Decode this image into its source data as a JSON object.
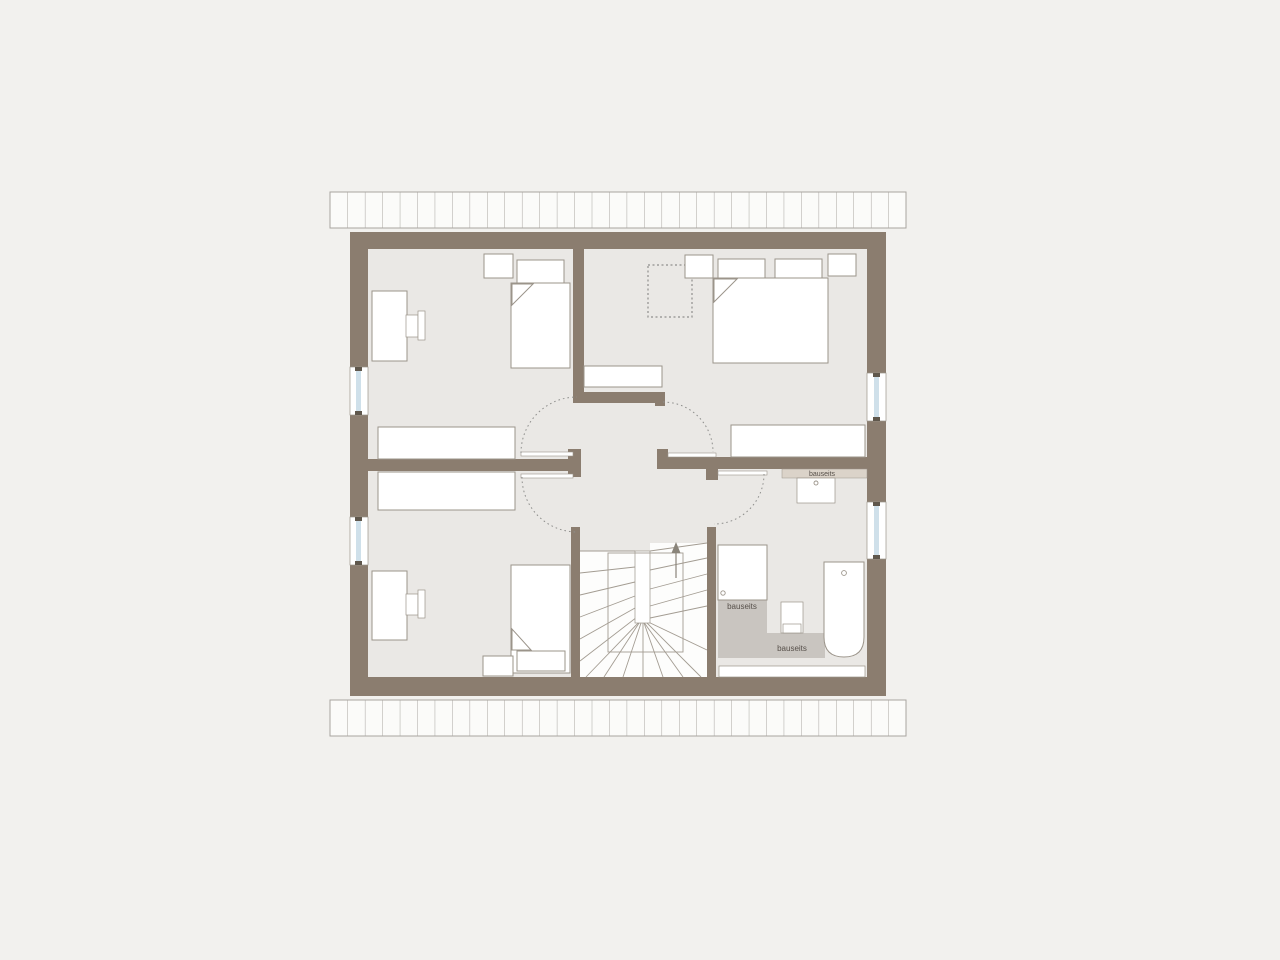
{
  "labels": {
    "washbasin_counter": "bauseits",
    "shower_area": "bauseits",
    "bath_floor": "bauseits"
  },
  "colors": {
    "background": "#f2f1ee",
    "floor": "#eae8e5",
    "wall": "#8b7d6f",
    "furniture_fill": "#ffffff",
    "furniture_stroke": "#9b948a",
    "window_glazing": "#cfe0ea",
    "window_tick": "#5f574c",
    "counter": "#dbd3c9",
    "bath_floor_zone": "#c9c5c0",
    "hatch_fill": "#fbfbf9",
    "hatch_line": "#a8a5a0",
    "door_swing": "#8f8f8d",
    "stair_line": "#a39c92",
    "stair_fill": "#fdfdfc",
    "stair_arrow": "#8a847a",
    "label_text": "#57504a"
  }
}
